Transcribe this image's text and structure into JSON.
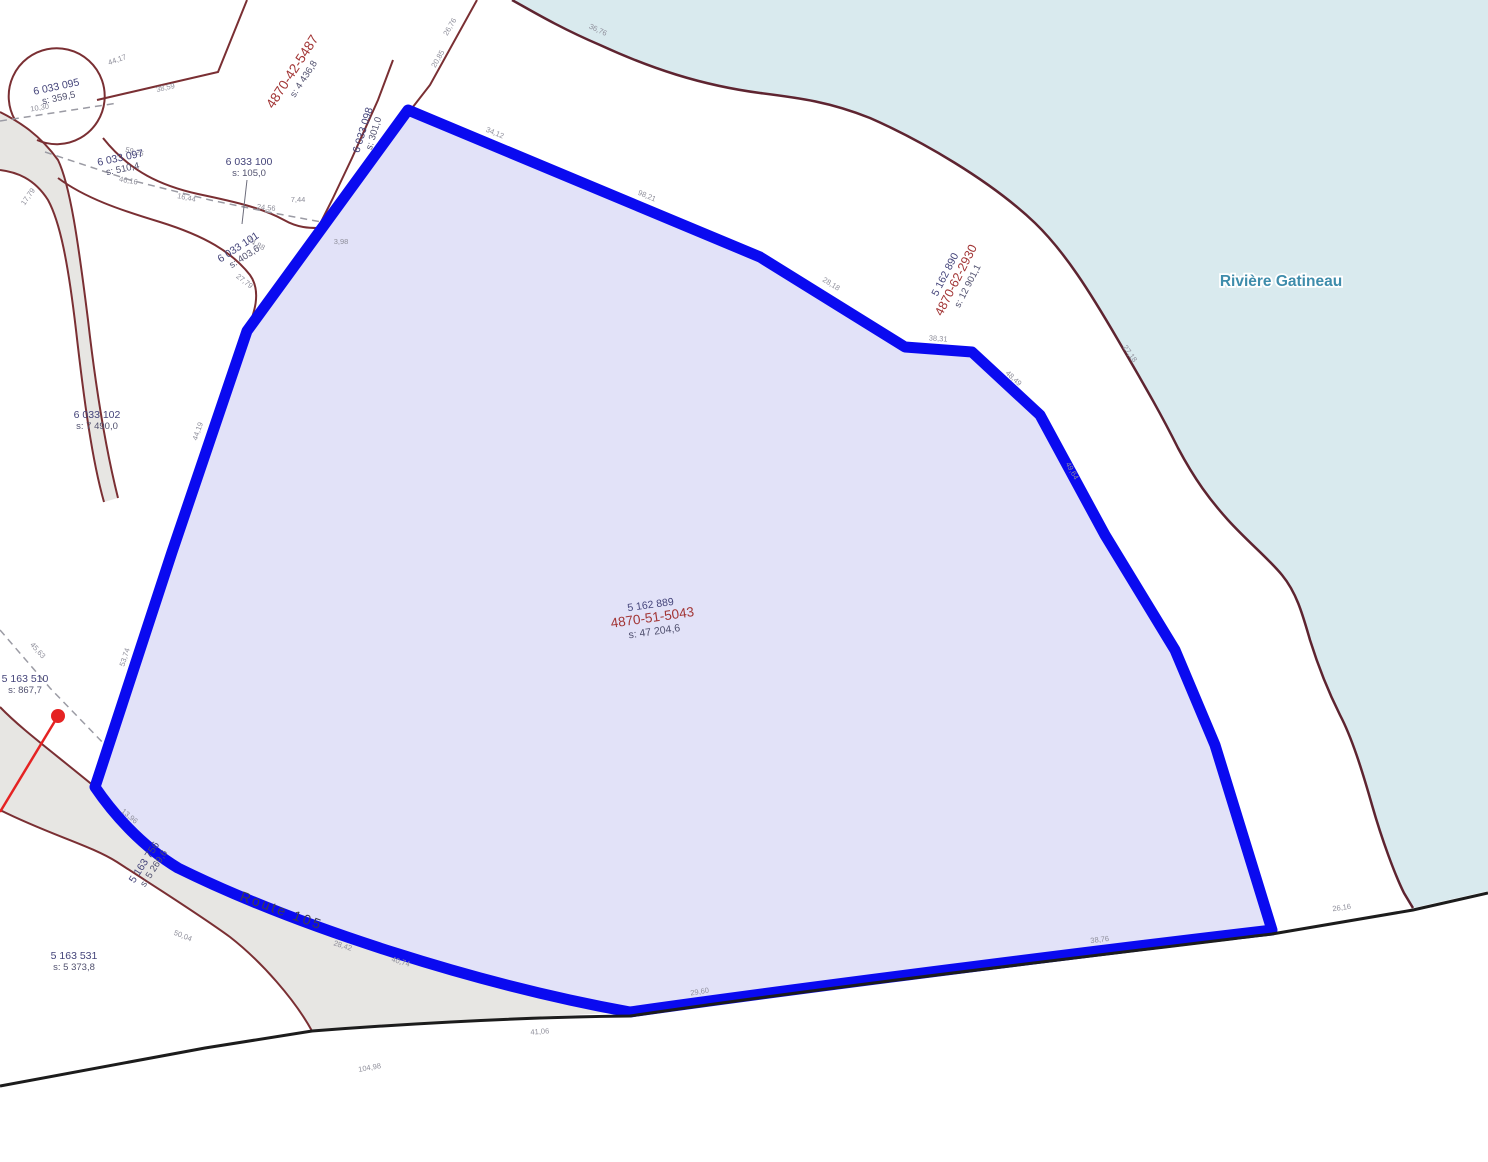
{
  "map": {
    "background": "#ffffff",
    "water": {
      "label": "Rivière Gatineau",
      "color": "#d9eaee",
      "label_color": "#3e8cab"
    },
    "road": {
      "label": "Route 105",
      "fill": "#e7e6e3",
      "border": "#7a2f33"
    },
    "highlight_parcel": {
      "fill": "#e2e2f8",
      "border": "#0a0af0"
    },
    "line_colors": {
      "lot_line": "#7a2f33",
      "shoreline": "#5e2430",
      "survey_black": "#1c1c1c",
      "dashed_gray": "#9b9ba4",
      "marker_red": "#e52323"
    },
    "text_colors": {
      "lot": "#44447a",
      "matricule": "#a23535",
      "area": "#50506e",
      "measure": "#8f8f9b",
      "route": "#3c3c50"
    },
    "parcel_labels": [
      {
        "name": "lot-6033095",
        "x": 57,
        "y": 90,
        "r": -12,
        "lines": [
          {
            "t": "6 033 095",
            "k": "lot",
            "dy": 0
          },
          {
            "t": "s: 359,5",
            "k": "area",
            "dy": 11
          }
        ]
      },
      {
        "name": "mat-4870-42-5487",
        "x": 296,
        "y": 74,
        "r": -57,
        "lines": [
          {
            "t": "4870-42-5487",
            "k": "matlg",
            "dy": 0
          },
          {
            "t": "s: 4 436,8",
            "k": "area",
            "dy": 12
          }
        ]
      },
      {
        "name": "lot-6033097",
        "x": 121,
        "y": 161,
        "r": -12,
        "lines": [
          {
            "t": "6 033 097",
            "k": "lot",
            "dy": 0
          },
          {
            "t": "s: 510,4",
            "k": "area",
            "dy": 11
          }
        ]
      },
      {
        "name": "lot-6033100",
        "x": 249,
        "y": 165,
        "r": 0,
        "lines": [
          {
            "t": "6 033 100",
            "k": "lot",
            "dy": 0
          },
          {
            "t": "s: 105,0",
            "k": "area",
            "dy": 11
          }
        ]
      },
      {
        "name": "lot-6033101",
        "x": 240,
        "y": 250,
        "r": -33,
        "lines": [
          {
            "t": "6 033 101",
            "k": "lot",
            "dy": 0
          },
          {
            "t": "s: 403,6",
            "k": "area",
            "dy": 11
          }
        ]
      },
      {
        "name": "lot-6033098",
        "x": 366,
        "y": 131,
        "r": -73,
        "lines": [
          {
            "t": "6 033 098",
            "k": "lot",
            "dy": 0
          },
          {
            "t": "s: 301,0",
            "k": "area",
            "dy": 11
          }
        ]
      },
      {
        "name": "lot-6033102",
        "x": 97,
        "y": 418,
        "r": 0,
        "lines": [
          {
            "t": "6 033 102",
            "k": "lot",
            "dy": 0
          },
          {
            "t": "s: 7 490,0",
            "k": "area",
            "dy": 11
          }
        ]
      },
      {
        "name": "lot-5163510",
        "x": 25,
        "y": 682,
        "r": 0,
        "lines": [
          {
            "t": "5 163 510",
            "k": "lot",
            "dy": 0
          },
          {
            "t": "s: 867,7",
            "k": "area",
            "dy": 11
          }
        ]
      },
      {
        "name": "lot-5163756",
        "x": 147,
        "y": 864,
        "r": -57,
        "lines": [
          {
            "t": "5 163 756",
            "k": "lot",
            "dy": 0
          },
          {
            "t": "s: 5 269,6",
            "k": "area",
            "dy": 11
          }
        ]
      },
      {
        "name": "lot-5163531",
        "x": 74,
        "y": 959,
        "r": 0,
        "lines": [
          {
            "t": "5 163 531",
            "k": "lot",
            "dy": 0
          },
          {
            "t": "s: 5 373,8",
            "k": "area",
            "dy": 11
          }
        ]
      },
      {
        "name": "lot-5162889-highlight",
        "x": 651,
        "y": 608,
        "r": -8,
        "lines": [
          {
            "t": "5 162 889",
            "k": "lot",
            "dy": 0
          },
          {
            "t": "4870-51-5043",
            "k": "matlg",
            "dy": 14
          },
          {
            "t": "s: 47 204,6",
            "k": "area2",
            "dy": 27
          }
        ]
      },
      {
        "name": "lot-5162890",
        "x": 948,
        "y": 276,
        "r": -63,
        "lines": [
          {
            "t": "5 162 890",
            "k": "lot",
            "dy": 0
          },
          {
            "t": "4870-62-2930",
            "k": "mat",
            "dy": 13
          },
          {
            "t": "s: 12 901,1",
            "k": "area",
            "dy": 25
          }
        ]
      }
    ],
    "measurements": [
      [
        "44,17",
        118,
        62,
        -20
      ],
      [
        "38,59",
        166,
        90,
        -13
      ],
      [
        "26,76",
        452,
        28,
        -60
      ],
      [
        "20,85",
        440,
        60,
        -60
      ],
      [
        "10,30",
        40,
        110,
        -9
      ],
      [
        "17,79",
        30,
        198,
        -55
      ],
      [
        "59,25",
        134,
        154,
        14
      ],
      [
        "46,16",
        128,
        183,
        10
      ],
      [
        "16,44",
        186,
        200,
        12
      ],
      [
        "24,56",
        266,
        210,
        6
      ],
      [
        "7,44",
        298,
        202,
        0
      ],
      [
        "3,98",
        341,
        244,
        0
      ],
      [
        "74,88",
        255,
        246,
        28
      ],
      [
        "27,79",
        243,
        283,
        38
      ],
      [
        "34,12",
        494,
        135,
        23
      ],
      [
        "98,21",
        646,
        198,
        23
      ],
      [
        "28,18",
        830,
        286,
        32
      ],
      [
        "38,31",
        938,
        341,
        4
      ],
      [
        "48,49",
        1012,
        380,
        43
      ],
      [
        "49,64",
        1070,
        472,
        61
      ],
      [
        "44,19",
        200,
        432,
        -71
      ],
      [
        "53,74",
        127,
        658,
        -72
      ],
      [
        "45,63",
        36,
        652,
        48
      ],
      [
        "13,96",
        128,
        818,
        40
      ],
      [
        "50,04",
        182,
        938,
        22
      ],
      [
        "28,42",
        342,
        948,
        18
      ],
      [
        "40,74",
        400,
        964,
        17
      ],
      [
        "41,06",
        540,
        1034,
        -4
      ],
      [
        "104,98",
        370,
        1070,
        -10
      ],
      [
        "29,60",
        700,
        994,
        -9
      ],
      [
        "38,76",
        1100,
        942,
        -7
      ],
      [
        "26,16",
        1342,
        910,
        -8
      ],
      [
        "36,76",
        597,
        32,
        25
      ],
      [
        "27,18",
        1128,
        355,
        55
      ]
    ]
  }
}
